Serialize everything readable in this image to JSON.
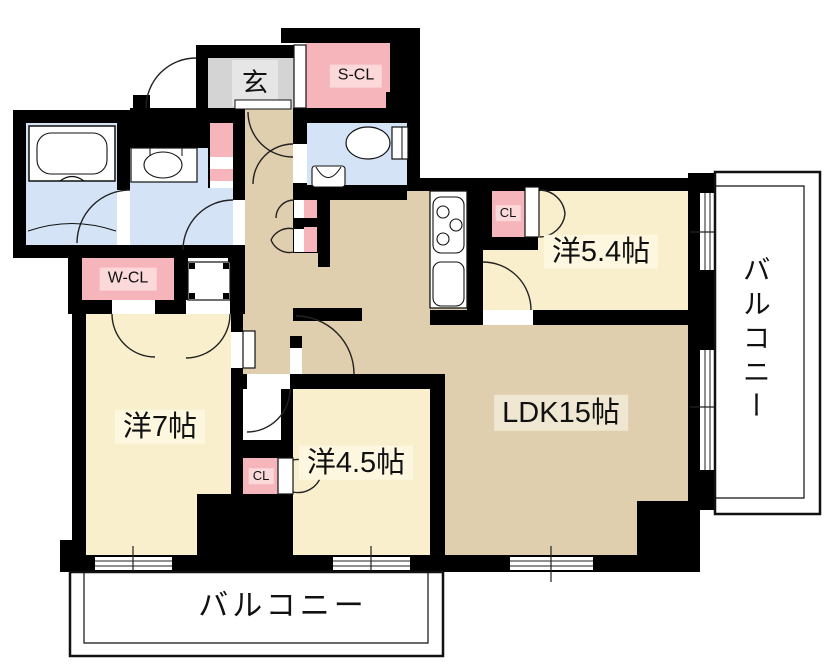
{
  "plan": {
    "title": "3LDK apartment floor plan",
    "rooms": {
      "genkan": "玄",
      "s_cl": "S-CL",
      "w_cl": "W-CL",
      "cl_upper": "CL",
      "cl_lower": "CL",
      "bedroom_54": "洋5.4帖",
      "bedroom_7": "洋7帖",
      "bedroom_45": "洋4.5帖",
      "ldk": "LDK15帖",
      "balcony_right": "バルコニー",
      "balcony_bottom": "バルコニー"
    },
    "colors": {
      "wall": "#000000",
      "room_cream": "#f9efcd",
      "room_tan": "#dfcfaf",
      "room_blue": "#d4e4f6",
      "room_pink": "#f6b5ba",
      "room_gray": "#d4d4d4",
      "chip_pink": "#fbd8da",
      "chip_cream": "#fdf7e0",
      "outline": "#1a1a1a"
    }
  }
}
